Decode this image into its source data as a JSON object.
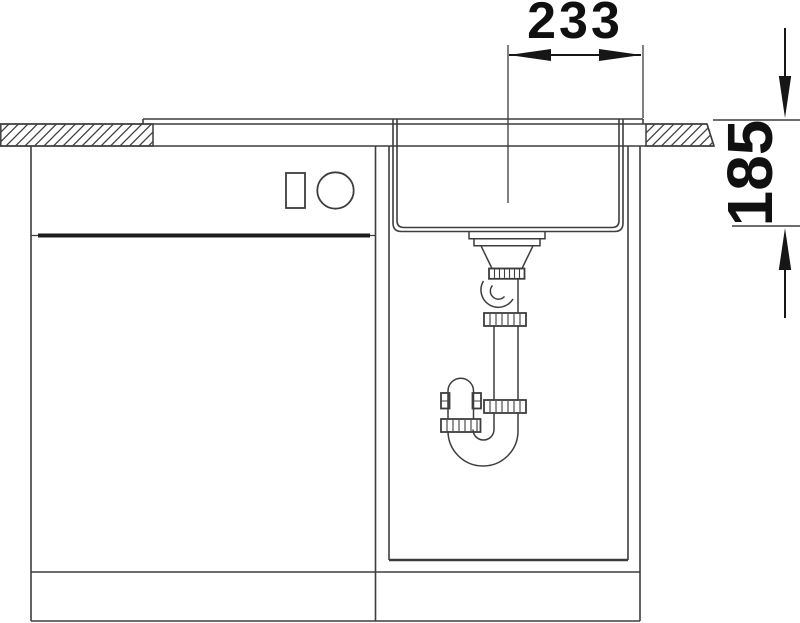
{
  "drawing": {
    "kind": "sink-installation-section",
    "dimensions": {
      "horizontal": {
        "value": "233"
      },
      "vertical": {
        "value": "185"
      }
    },
    "colors": {
      "line": "#3d3d3d",
      "emphasis": "#161616",
      "background": "#ffffff"
    }
  }
}
